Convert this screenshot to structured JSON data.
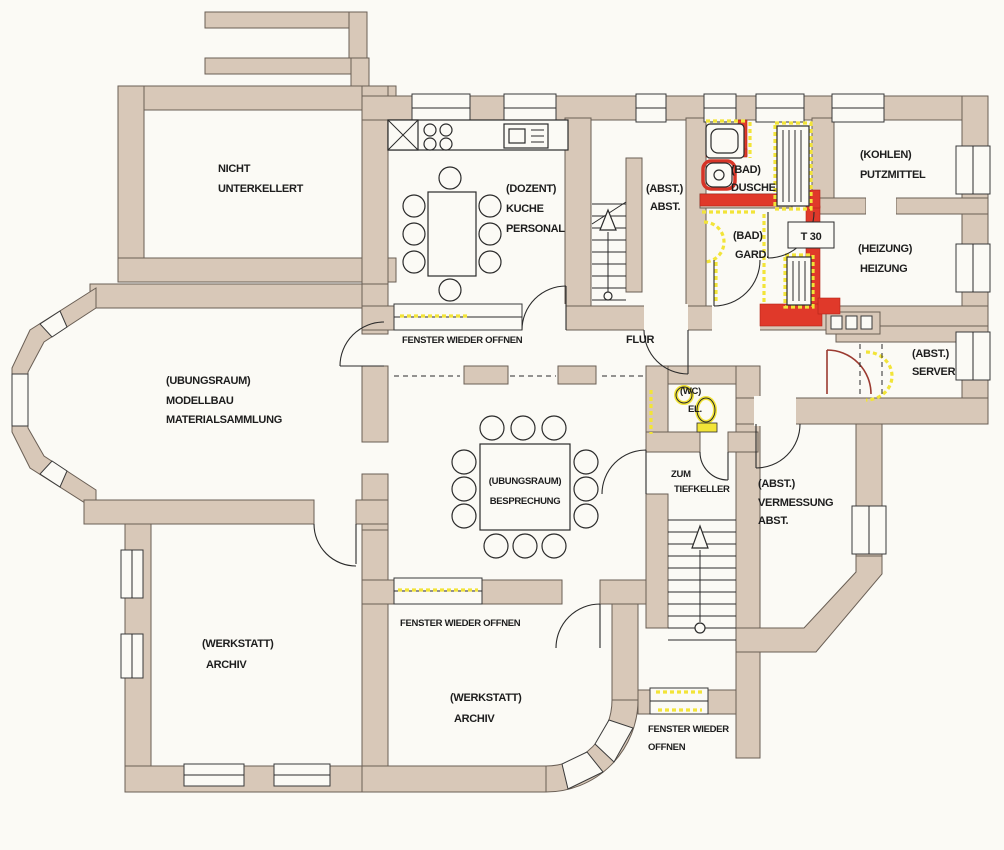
{
  "title": "Kellergeschoss Grundriss",
  "colors": {
    "wall": "#d8c8b8",
    "wall_outline": "#6a5f55",
    "paper": "#fbfaf5",
    "ink": "#1d1d1d",
    "highlight_red": "#e0392a",
    "highlight_yellow": "#f2e438",
    "door_leaf_red": "#9b3a30"
  },
  "rooms": {
    "nicht_unterkellert": {
      "lines": [
        "NICHT",
        "UNTERKELLERT"
      ]
    },
    "kueche": {
      "lines": [
        "(DOZENT)",
        "KUCHE",
        "PERSONAL"
      ]
    },
    "treppe_abst": {
      "lines": [
        "(ABST.)",
        "ABST."
      ]
    },
    "bad_dusche": {
      "lines": [
        "(BAD)",
        "DUSCHE"
      ]
    },
    "bad_gard": {
      "lines": [
        "(BAD)",
        "GARD."
      ]
    },
    "kohlen": {
      "lines": [
        "(KOHLEN)",
        "PUTZMITTEL"
      ]
    },
    "heizung": {
      "lines": [
        "(HEIZUNG)",
        "HEIZUNG"
      ]
    },
    "flur": {
      "label": "FLUR"
    },
    "server": {
      "lines": [
        "(ABST.)",
        "SERVER"
      ]
    },
    "wc": {
      "lines": [
        "(WC)",
        "EL."
      ]
    },
    "modellbau": {
      "lines": [
        "(UBUNGSRAUM)",
        "MODELLBAU",
        "MATERIALSAMMLUNG"
      ]
    },
    "besprechung": {
      "lines": [
        "(UBUNGSRAUM)",
        "BESPRECHUNG"
      ]
    },
    "tiefkeller": {
      "lines": [
        "ZUM",
        "TIEFKELLER"
      ]
    },
    "vermessung": {
      "lines": [
        "(ABST.)",
        "VERMESSUNG",
        "ABST."
      ]
    },
    "werkstatt_links": {
      "lines": [
        "(WERKSTATT)",
        "ARCHIV"
      ]
    },
    "werkstatt_mitte": {
      "lines": [
        "(WERKSTATT)",
        "ARCHIV"
      ]
    }
  },
  "annotations": {
    "fenster_kueche": "FENSTER WIEDER OFFNEN",
    "fenster_werkstatt": "FENSTER WIEDER OFFNEN",
    "fenster_sued_line1": "FENSTER WIEDER",
    "fenster_sued_line2": "OFFNEN",
    "door_rating": "T 30"
  }
}
